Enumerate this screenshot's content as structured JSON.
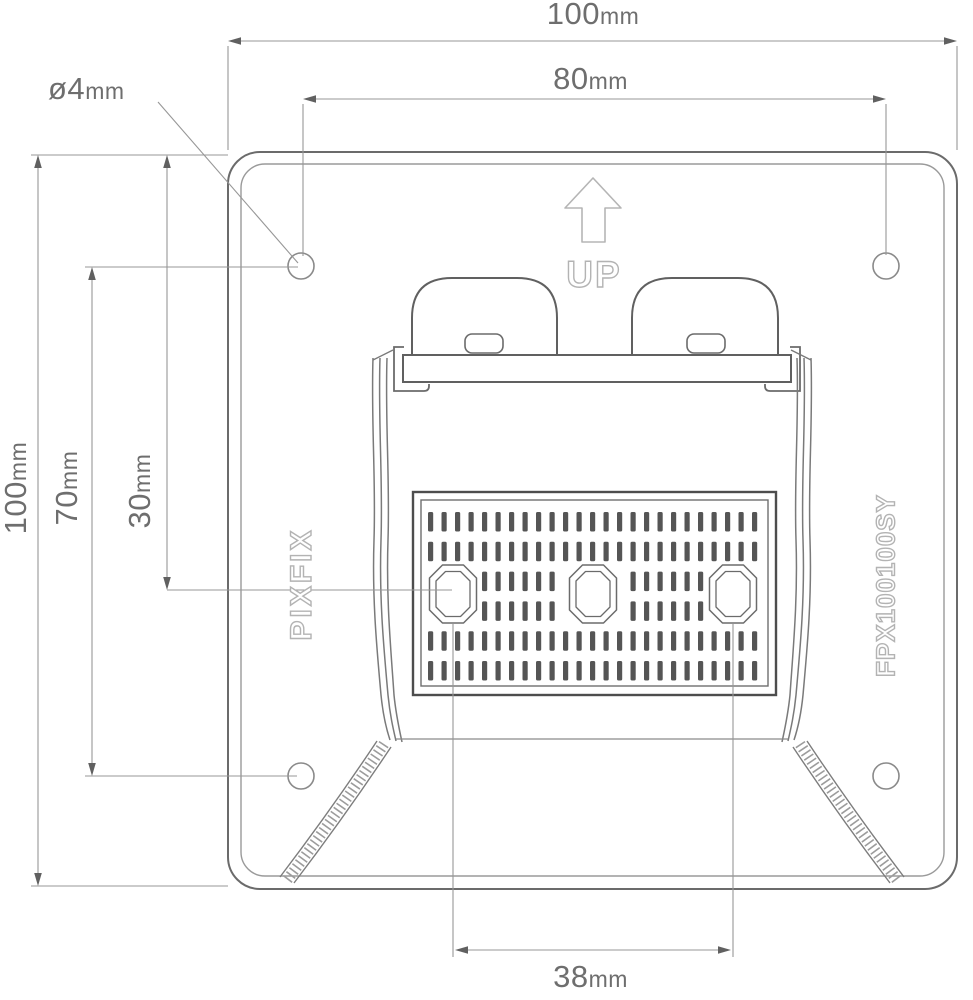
{
  "drawing": {
    "product": {
      "brand": "PIXFIX",
      "model": "FPX100100SY",
      "orientation_label": "UP"
    },
    "dimensions": {
      "plate_width": {
        "value": "100",
        "unit": "mm"
      },
      "hole_spacing_horizontal": {
        "value": "80",
        "unit": "mm"
      },
      "hole_diameter": {
        "value": "ø4",
        "unit": "mm"
      },
      "plate_height": {
        "value": "100",
        "unit": "mm"
      },
      "hole_spacing_vertical": {
        "value": "70",
        "unit": "mm"
      },
      "top_to_slot_row": {
        "value": "30",
        "unit": "mm"
      },
      "slot_spacing": {
        "value": "38",
        "unit": "mm"
      }
    }
  },
  "colors": {
    "dim_line": "#979797",
    "dim_arrow": "#606060",
    "dim_text": "#6e6e6e",
    "outline_text": "#b3b3b3",
    "plate_line": "#6b6b6b",
    "bracket_line": "#606060",
    "slot": "#555555",
    "background": "#ffffff"
  }
}
